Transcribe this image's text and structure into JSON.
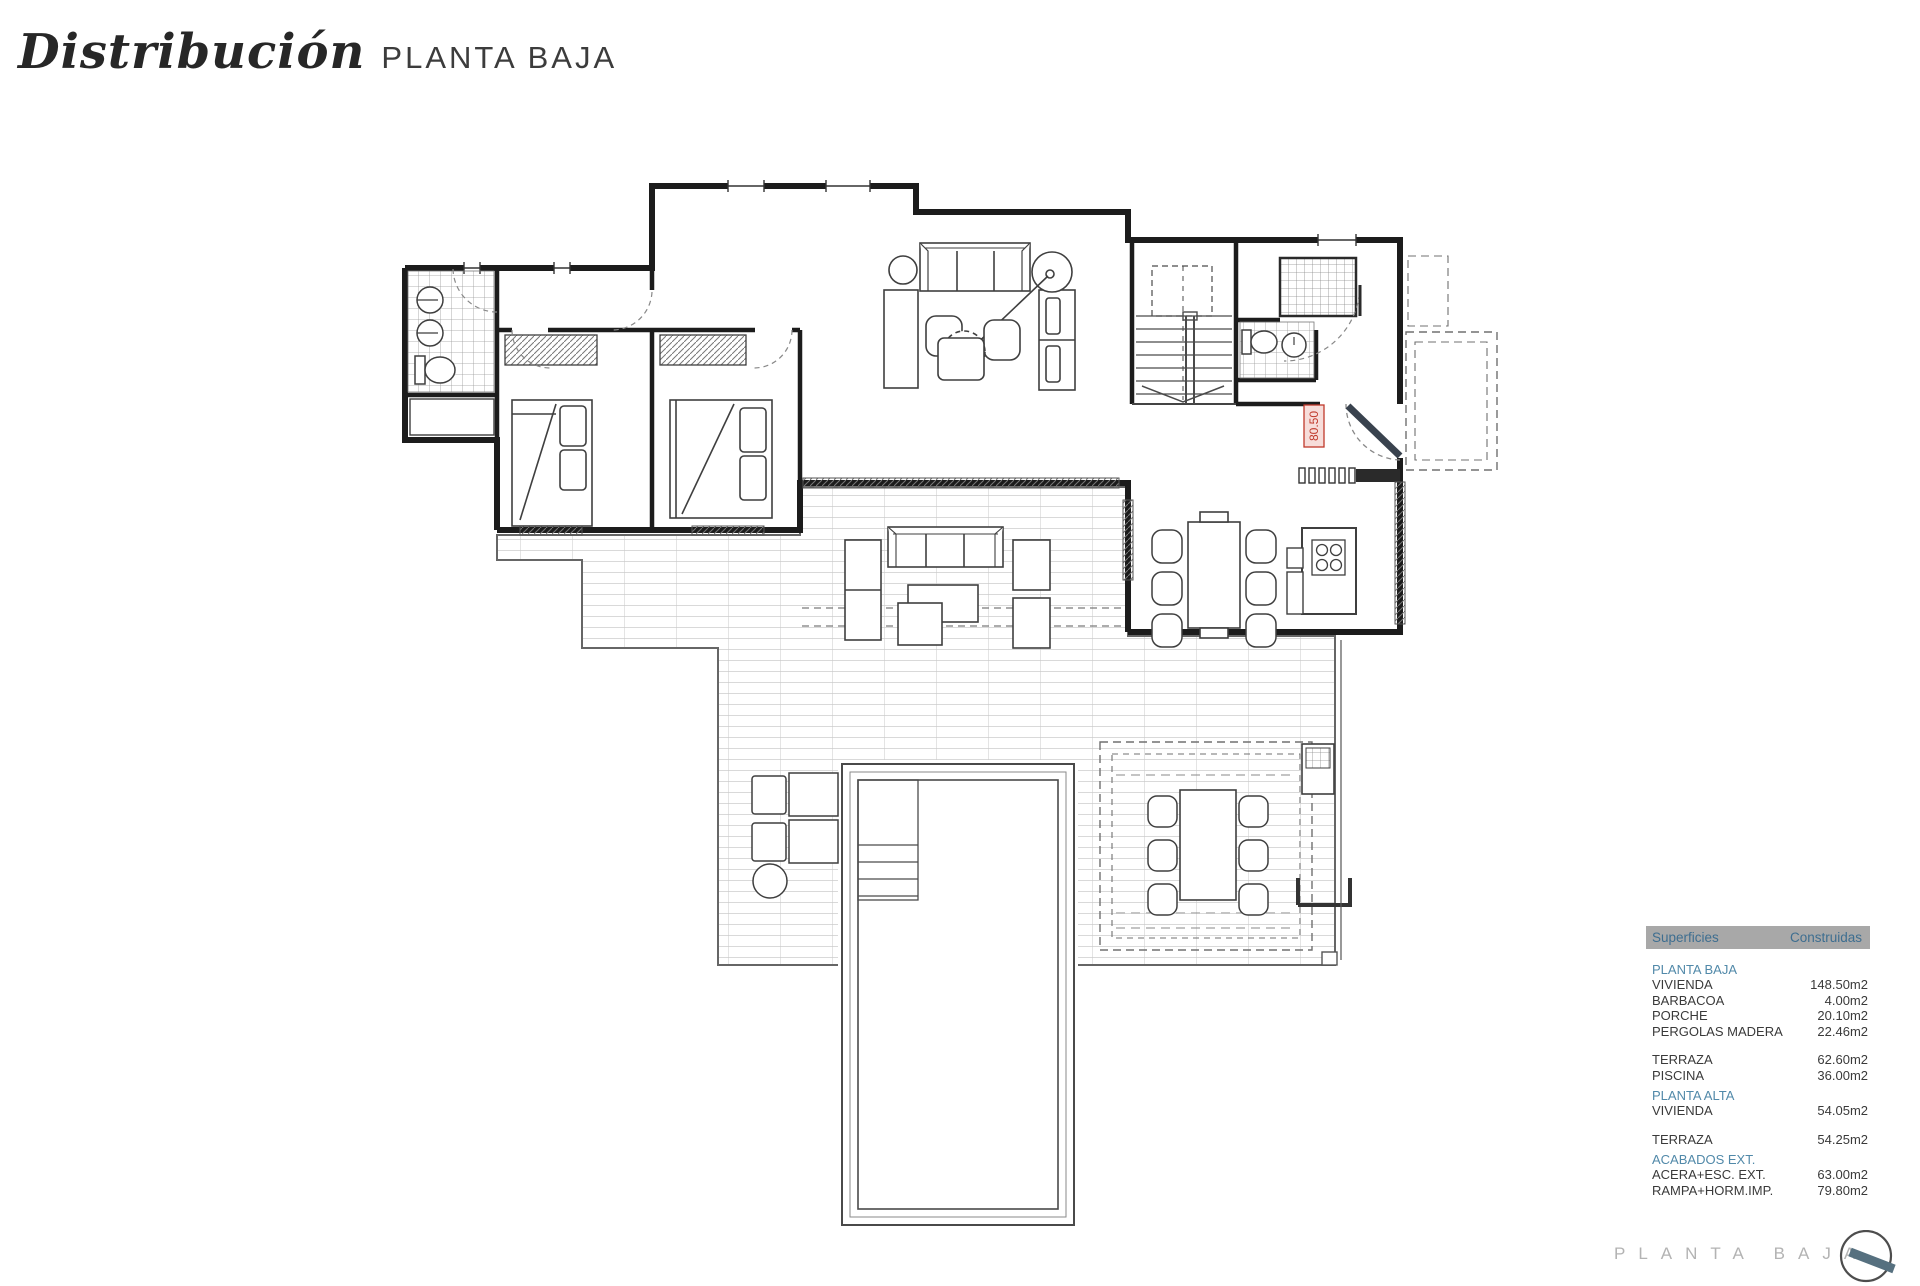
{
  "header": {
    "title": "Distribución",
    "subtitle": "PLANTA BAJA"
  },
  "plan": {
    "door_label": "80.50"
  },
  "areas_table": {
    "col_surface": "Superficies",
    "col_built": "Construidas",
    "rows": [
      {
        "kind": "section",
        "label": "PLANTA BAJA",
        "value": ""
      },
      {
        "kind": "item",
        "label": "VIVIENDA",
        "value": "148.50m2"
      },
      {
        "kind": "item",
        "label": "BARBACOA",
        "value": "4.00m2"
      },
      {
        "kind": "item",
        "label": "PORCHE",
        "value": "20.10m2"
      },
      {
        "kind": "item",
        "label": "PERGOLAS MADERA",
        "value": "22.46m2"
      },
      {
        "kind": "gap",
        "label": "",
        "value": ""
      },
      {
        "kind": "item",
        "label": "TERRAZA",
        "value": "62.60m2"
      },
      {
        "kind": "item",
        "label": "PISCINA",
        "value": "36.00m2"
      },
      {
        "kind": "section",
        "label": "PLANTA ALTA",
        "value": ""
      },
      {
        "kind": "item",
        "label": "VIVIENDA",
        "value": "54.05m2"
      },
      {
        "kind": "gap",
        "label": "",
        "value": ""
      },
      {
        "kind": "item",
        "label": "TERRAZA",
        "value": "54.25m2"
      },
      {
        "kind": "section",
        "label": "ACABADOS EXT.",
        "value": ""
      },
      {
        "kind": "item",
        "label": "ACERA+ESC. EXT.",
        "value": "63.00m2"
      },
      {
        "kind": "item",
        "label": "RAMPA+HORM.IMP.",
        "value": "79.80m2"
      }
    ]
  },
  "footer": {
    "label": "PLANTA BAJA"
  },
  "colors": {
    "accent_blue": "#5189a9",
    "table_header_bg": "#a8a8a8",
    "door_label_red": "#c0392b",
    "door_leaf_slate": "#39424e",
    "logo_bar": "#56707f",
    "footer_gray": "#b3b3b3",
    "wall_black": "#1c1c1c"
  }
}
